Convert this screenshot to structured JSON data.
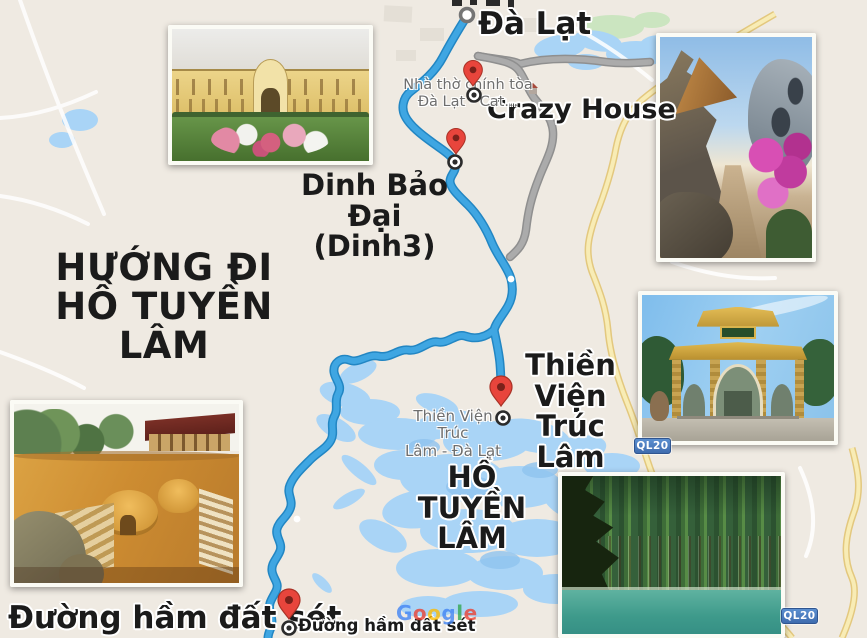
{
  "heading": {
    "line1": "HƯỚNG ĐI",
    "line2": "HỒ TUYỀN LÂM"
  },
  "map_labels": {
    "city": "Đà Lạt",
    "crazy_house": "Crazy House",
    "dinh_bao_dai": {
      "line1": "Dinh Bảo Đại",
      "line2": "(Dinh3)"
    },
    "thien_vien": {
      "line1": "Thiền Viện",
      "line2": "Trúc Lâm"
    },
    "lake": {
      "line1": "HỒ",
      "line2": "TUYỀN LÂM"
    },
    "clay_tunnel": "Đường hầm đất sét",
    "poi_cathedral": {
      "line1": "Nhà thờ chính tòa",
      "line2": "Đà Lạt - Cat..."
    },
    "poi_thien_vien": {
      "line1": "Thiền Viện Trúc",
      "line2": "Lâm - Đà Lạt"
    },
    "poi_clay_tunnel": "Đường hầm đất sét"
  },
  "badges": {
    "route_shield": "QL20"
  },
  "watermark": {
    "text": "Google",
    "letter_colors": [
      "#4285F4",
      "#EA4335",
      "#FBBC05",
      "#4285F4",
      "#34A853",
      "#EA4335"
    ]
  },
  "colors": {
    "map_background": "#EFEAE2",
    "route_blue": "#3FA6E2",
    "route_blue_casing": "#2286C3",
    "alt_route_gray": "#A6A6A6",
    "water_blue": "#A9D4F6",
    "highway_yellow": "#F8ECB5",
    "pin_red": "#E8453C",
    "shield_blue": "#4C7FC4",
    "label_black": "#1B1B1B",
    "label_gray": "#6E6E6E"
  },
  "photos": {
    "palace": "Dinh Bảo Đại palace and flower garden",
    "crazy_house": "Crazy House Đà Lạt towers and bougainvillea",
    "thien_vien_gate": "Thiền Viện Trúc Lâm golden gate",
    "tuyen_lam_lake": "Tuyền Lâm lake with pine forest",
    "clay_tunnel": "Đường hầm đất sét clay sculpture park"
  }
}
